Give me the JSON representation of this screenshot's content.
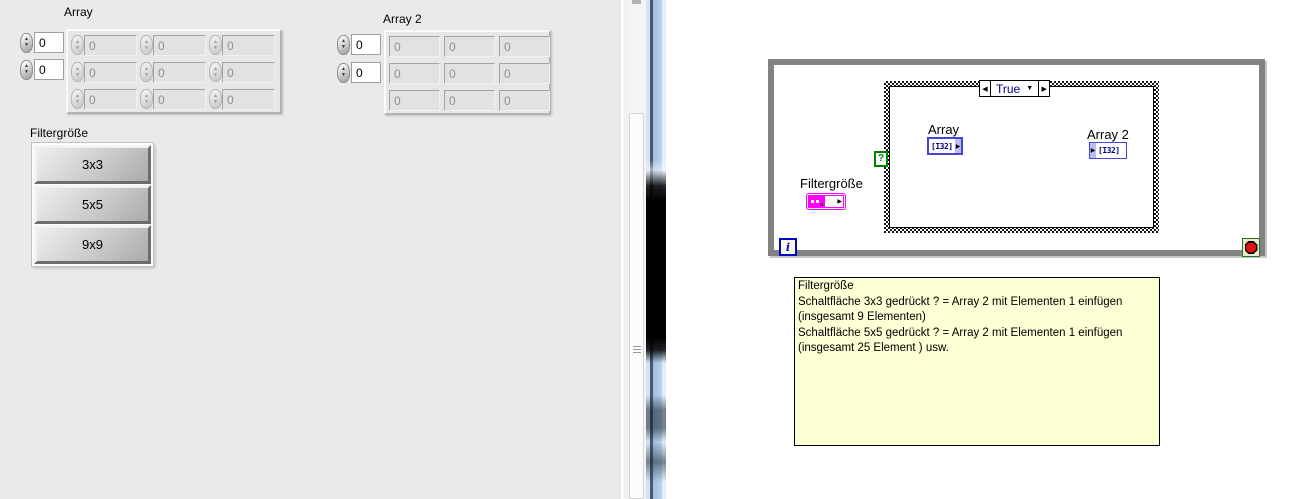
{
  "front_panel": {
    "array1": {
      "label": "Array",
      "index": [
        "0",
        "0"
      ],
      "cells": [
        [
          "0",
          "0",
          "0"
        ],
        [
          "0",
          "0",
          "0"
        ],
        [
          "0",
          "0",
          "0"
        ]
      ]
    },
    "array2": {
      "label": "Array 2",
      "index": [
        "0",
        "0"
      ],
      "cells": [
        [
          "0",
          "0",
          "0"
        ],
        [
          "0",
          "0",
          "0"
        ],
        [
          "0",
          "0",
          "0"
        ]
      ]
    },
    "filter": {
      "label": "Filtergröße",
      "buttons": [
        "3x3",
        "5x5",
        "9x9"
      ]
    }
  },
  "block_diagram": {
    "case_selector_value": "True",
    "selector_terminal": "?",
    "iteration": "i",
    "terminals": {
      "array": {
        "label": "Array",
        "type": "[I32]"
      },
      "array2": {
        "label": "Array 2",
        "type": "[I32]"
      },
      "filter": {
        "label": "Filtergröße"
      }
    },
    "comment": {
      "lines": [
        "Filtergröße",
        "Schaltfläche 3x3 gedrückt ? = Array 2 mit Elementen 1 einfügen",
        "(insgesamt 9 Elementen)",
        "Schaltfläche 5x5 gedrückt ? = Array 2 mit Elementen 1 einfügen",
        "(insgesamt 25 Element ) usw."
      ]
    }
  },
  "icons": {
    "spinner_up": "▲",
    "spinner_down": "▼",
    "case_prev": "◀",
    "case_next": "▶",
    "case_dropdown": "▼",
    "terminal_arrow": "▶"
  },
  "colors": {
    "panel_gray": "#eaeaea",
    "terminal_blue": "#4444d8",
    "terminal_navy": "#00007f",
    "cluster_magenta": "#ff00ff",
    "selector_green": "#008000",
    "loop_gray": "#828282",
    "stop_red": "#e01212",
    "comment_bg": "#fdffd5"
  }
}
